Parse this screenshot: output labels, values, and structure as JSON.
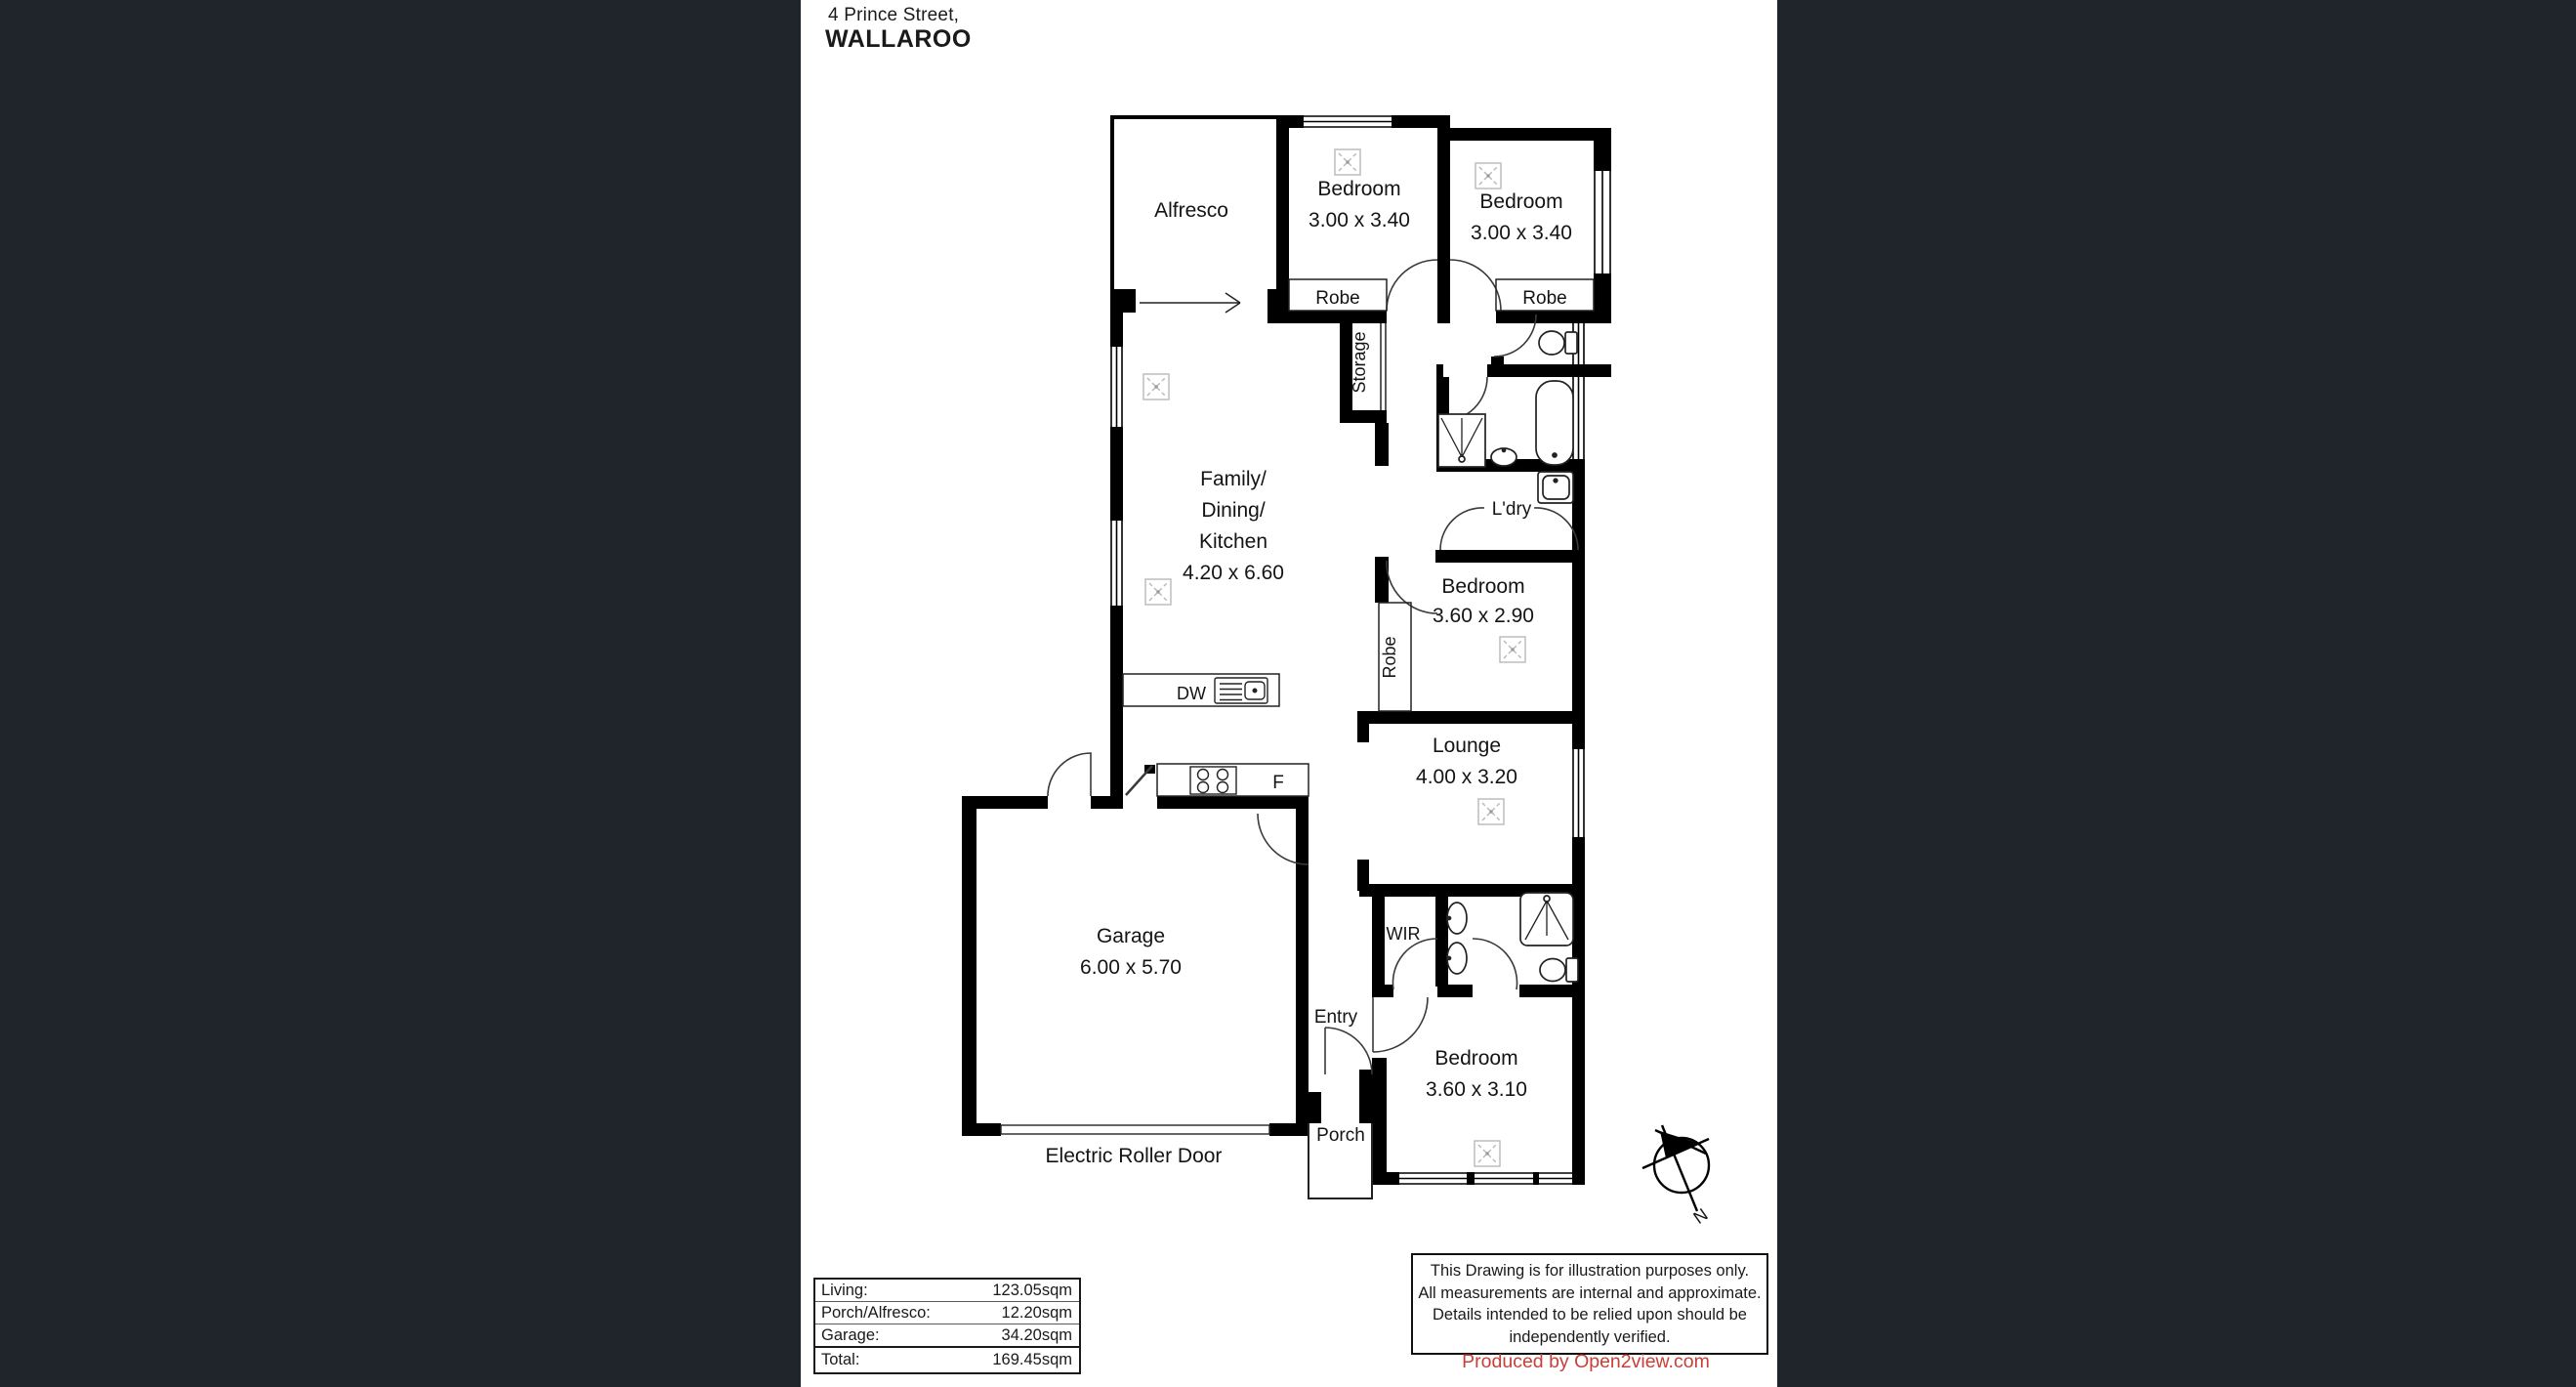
{
  "header": {
    "address_line1": "4 Prince Street,",
    "address_line2": "WALLAROO"
  },
  "plan": {
    "rooms": {
      "alfresco": {
        "label": "Alfresco"
      },
      "bedroom1": {
        "name": "Bedroom",
        "dims": "3.00 x 3.40"
      },
      "bedroom2": {
        "name": "Bedroom",
        "dims": "3.00 x 3.40"
      },
      "robe1": {
        "label": "Robe"
      },
      "robe2": {
        "label": "Robe"
      },
      "storage": {
        "label": "Storage"
      },
      "family": {
        "line1": "Family/",
        "line2": "Dining/",
        "line3": "Kitchen",
        "dims": "4.20 x 6.60"
      },
      "laundry": {
        "label": "L'dry"
      },
      "bedroom3": {
        "name": "Bedroom",
        "dims": "3.60 x 2.90"
      },
      "robe3": {
        "label": "Robe"
      },
      "lounge": {
        "name": "Lounge",
        "dims": "4.00 x 3.20"
      },
      "garage": {
        "name": "Garage",
        "dims": "6.00 x 5.70"
      },
      "entry": {
        "label": "Entry"
      },
      "porch": {
        "label": "Porch"
      },
      "wir": {
        "label": "WIR"
      },
      "bedroom4": {
        "name": "Bedroom",
        "dims": "3.60 x 3.10"
      }
    },
    "appliances": {
      "dishwasher": "DW",
      "fridge": "F"
    },
    "roller_door_label": "Electric Roller Door",
    "compass_north": "N"
  },
  "area_table": {
    "rows": [
      {
        "label": "Living:",
        "value": "123.05sqm"
      },
      {
        "label": "Porch/Alfresco:",
        "value": "12.20sqm"
      },
      {
        "label": "Garage:",
        "value": "34.20sqm"
      }
    ],
    "total": {
      "label": "Total:",
      "value": "169.45sqm"
    }
  },
  "disclaimer": {
    "line1": "This Drawing is for illustration purposes only.",
    "line2": "All measurements are internal and approximate.",
    "line3": "Details intended to be relied upon should be",
    "line4": "independently verified."
  },
  "credit": {
    "text": "Produced by Open2view.com"
  },
  "colors": {
    "letterbox_background": "#20252c",
    "paper": "#ffffff",
    "walls": "#000000",
    "credit_red": "#c84038",
    "fan_symbol_gray": "#b8b8b8"
  }
}
